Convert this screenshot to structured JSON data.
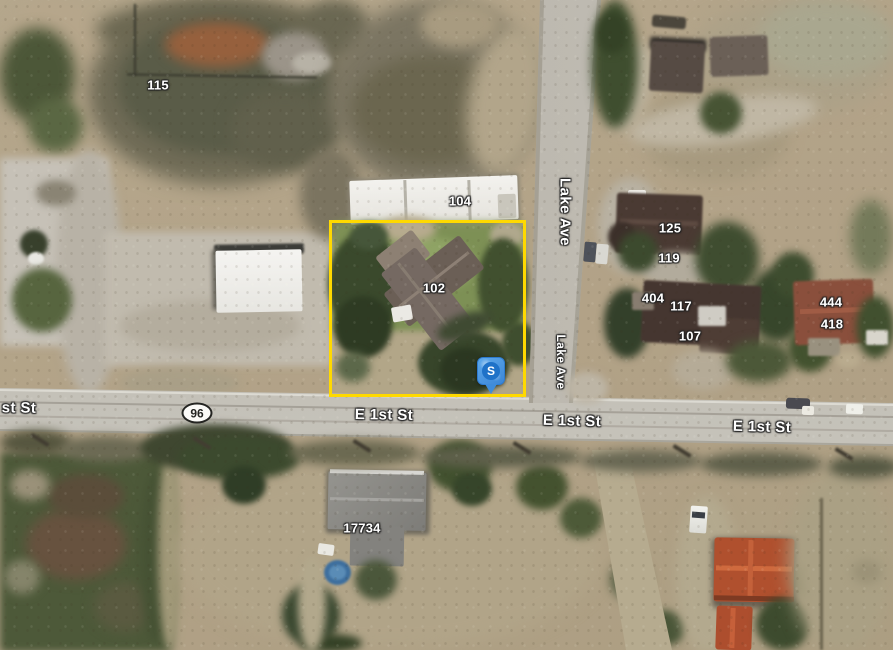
{
  "map": {
    "route_shield": "96",
    "marker": {
      "letter": "S"
    },
    "streets": {
      "e1st_partial": "st St",
      "e1st_a": "E 1st St",
      "e1st_b": "E 1st St",
      "e1st_c": "E 1st St",
      "lake_a": "Lake Ave",
      "lake_b": "Lake Ave"
    },
    "addresses": {
      "n115": "115",
      "n104": "104",
      "n102": "102",
      "n125": "125",
      "n119": "119",
      "n404": "404",
      "n117": "117",
      "n107": "107",
      "n444": "444",
      "n418": "418",
      "n17734": "17734"
    },
    "colors": {
      "parcel_outline": "#ffd900",
      "marker_blue": "#3f8cda"
    }
  }
}
